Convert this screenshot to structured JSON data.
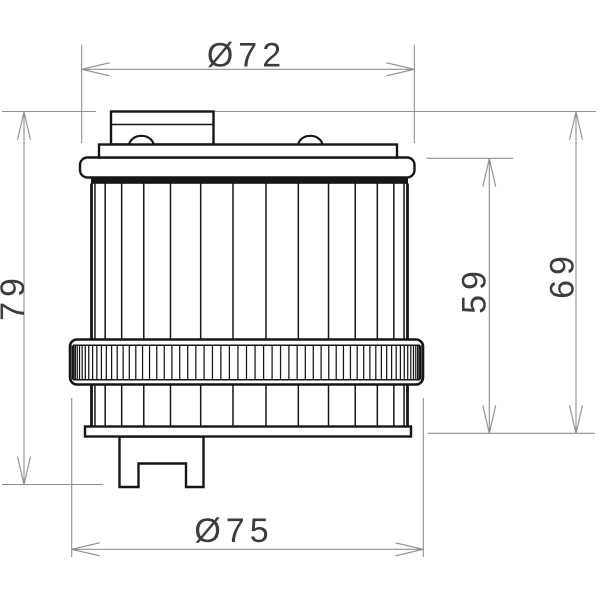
{
  "drawing": {
    "labels": {
      "top_diameter": "Ø72",
      "bottom_diameter": "Ø75",
      "overall_height": "79",
      "body_height": "59",
      "upper_height": "69"
    },
    "values_mm": {
      "top_diameter": 72,
      "bottom_diameter": 75,
      "overall_height": 79,
      "body_height": 59,
      "upper_height": 69
    },
    "colors": {
      "background": "#ffffff",
      "object_line": "#161616",
      "dimension_line": "#8f8f8f",
      "label_text": "#3c3c3c"
    }
  }
}
